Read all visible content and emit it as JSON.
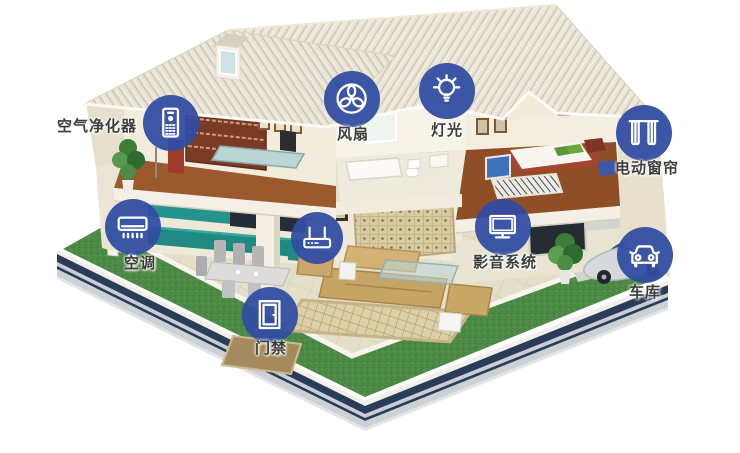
{
  "meta": {
    "description": "智能家居系统别墅剖面示意图",
    "background": "#ffffff"
  },
  "colors": {
    "marker_blue": "#314da3",
    "label_text": "#3d3d3b",
    "lawn_green": "#4d8a47",
    "roof_beige": "#e7e2d4",
    "platform_border_navy": "#2b3c58"
  },
  "annotations": [
    {
      "id": "air-purifier",
      "label": "空气净化器"
    },
    {
      "id": "fan",
      "label": "风扇"
    },
    {
      "id": "light",
      "label": "灯光"
    },
    {
      "id": "curtain",
      "label": "电动窗帘"
    },
    {
      "id": "ac",
      "label": "空调"
    },
    {
      "id": "router",
      "label": ""
    },
    {
      "id": "av",
      "label": "影音系统"
    },
    {
      "id": "garage",
      "label": "车库"
    },
    {
      "id": "door",
      "label": "门禁"
    }
  ]
}
